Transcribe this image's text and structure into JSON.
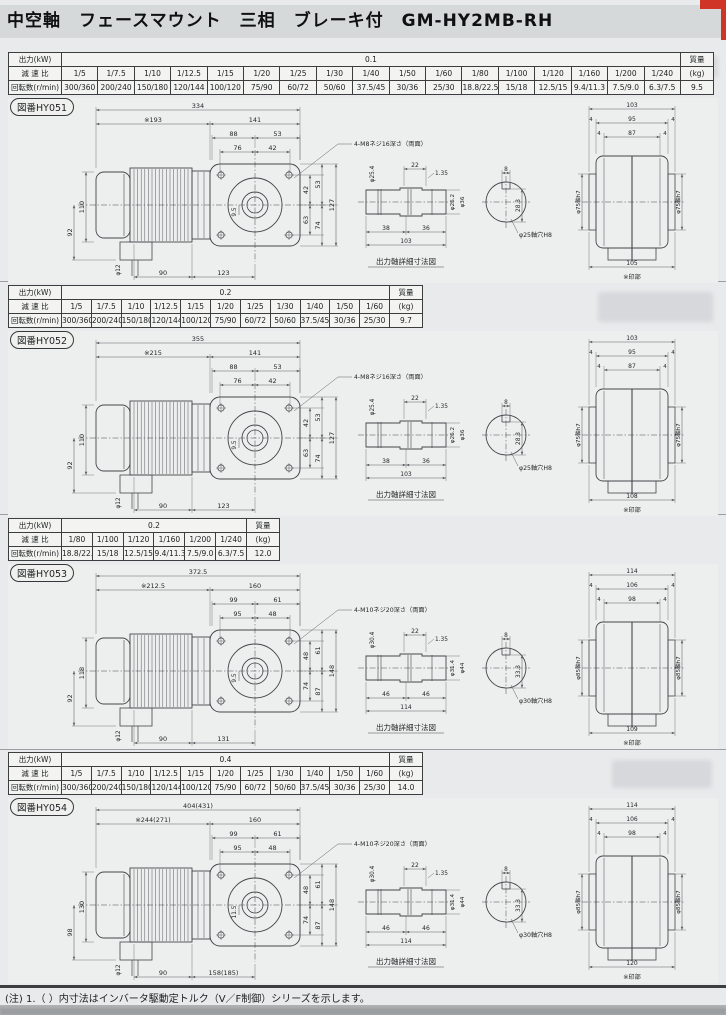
{
  "page": {
    "title": "中空軸　フェースマウント　三相　ブレーキ付　GM-HY2MB-RH",
    "footnote": "(注) 1.（ ）内寸法はインバータ駆動定トルク（V／F制御）シリーズを示します。"
  },
  "table_headers": {
    "output": "出力(kW)",
    "ratio": "減 速 比",
    "speed": "回転数(r/min)",
    "mass_top": "質量",
    "mass_unit": "(kg)"
  },
  "sections": [
    {
      "figure_no": "図番HY051",
      "spec": {
        "output_kw": "0.1",
        "mass_kg": "9.5",
        "ratios": [
          "1/5",
          "1/7.5",
          "1/10",
          "1/12.5",
          "1/15",
          "1/20",
          "1/25",
          "1/30",
          "1/40",
          "1/50",
          "1/60",
          "1/80",
          "1/100",
          "1/120",
          "1/160",
          "1/200",
          "1/240"
        ],
        "speeds": [
          "300/360",
          "200/240",
          "150/180",
          "120/144",
          "100/120",
          "75/90",
          "60/72",
          "50/60",
          "37.5/45",
          "30/36",
          "25/30",
          "18.8/22.5",
          "15/18",
          "12.5/15",
          "9.4/11.3",
          "7.5/9.0",
          "6.3/7.5"
        ]
      },
      "drawing": {
        "total": "334",
        "motor_len": "※193",
        "gear_len": "141",
        "face_top_a": "88",
        "face_top_b": "53",
        "face_top_c": "76",
        "face_top_d": "42",
        "callout": "4-M8ネジ16深さ（両面）",
        "motor_h": "110",
        "motor_h2": "92",
        "lead": "φ12",
        "bottom_a": "90",
        "bottom_b": "123",
        "right_a": "42",
        "right_b": "53",
        "right_c": "63",
        "right_d": "74",
        "right_e": "127",
        "inner": "9.5",
        "shaft": {
          "groove_w": "22",
          "groove_p": "1.35",
          "dia1": "φ25.4",
          "dia2": "φ26.2",
          "dia3": "φ36",
          "len_a": "38",
          "len_b": "36",
          "len_total": "103",
          "key_w": "8",
          "key_d": "28.3",
          "bore": "φ25軸穴H8",
          "caption": "出力軸詳細寸法図"
        },
        "end": {
          "w1": "103",
          "w2": "95",
          "w3": "87",
          "edge": "4",
          "side": "φ75軸h7",
          "w_bot": "105",
          "note": "※印部"
        }
      }
    },
    {
      "figure_no": "図番HY052",
      "spec": {
        "output_kw": "0.2",
        "mass_kg": "9.7",
        "ratios": [
          "1/5",
          "1/7.5",
          "1/10",
          "1/12.5",
          "1/15",
          "1/20",
          "1/25",
          "1/30",
          "1/40",
          "1/50",
          "1/60"
        ],
        "speeds": [
          "300/360",
          "200/240",
          "150/180",
          "120/144",
          "100/120",
          "75/90",
          "60/72",
          "50/60",
          "37.5/45",
          "30/36",
          "25/30"
        ]
      },
      "drawing": {
        "total": "355",
        "motor_len": "※215",
        "gear_len": "141",
        "face_top_a": "88",
        "face_top_b": "53",
        "face_top_c": "76",
        "face_top_d": "42",
        "callout": "4-M8ネジ16深さ（両面）",
        "motor_h": "110",
        "motor_h2": "92",
        "lead": "φ12",
        "bottom_a": "90",
        "bottom_b": "123",
        "right_a": "42",
        "right_b": "53",
        "right_c": "63",
        "right_d": "74",
        "right_e": "127",
        "inner": "9.5",
        "shaft": {
          "groove_w": "22",
          "groove_p": "1.35",
          "dia1": "φ25.4",
          "dia2": "φ26.2",
          "dia3": "φ36",
          "len_a": "38",
          "len_b": "36",
          "len_total": "103",
          "key_w": "8",
          "key_d": "28.3",
          "bore": "φ25軸穴H8",
          "caption": "出力軸詳細寸法図"
        },
        "end": {
          "w1": "103",
          "w2": "95",
          "w3": "87",
          "edge": "4",
          "side": "φ75軸h7",
          "w_bot": "108",
          "note": "※印部"
        }
      }
    },
    {
      "figure_no": "図番HY053",
      "spec": {
        "output_kw": "0.2",
        "mass_kg": "12.0",
        "ratios": [
          "1/80",
          "1/100",
          "1/120",
          "1/160",
          "1/200",
          "1/240"
        ],
        "speeds": [
          "18.8/22.5",
          "15/18",
          "12.5/15",
          "9.4/11.3",
          "7.5/9.0",
          "6.3/7.5"
        ]
      },
      "drawing": {
        "total": "372.5",
        "motor_len": "※212.5",
        "gear_len": "160",
        "face_top_a": "99",
        "face_top_b": "61",
        "face_top_c": "95",
        "face_top_d": "48",
        "callout": "4-M10ネジ20深さ（両面）",
        "motor_h": "118",
        "motor_h2": "92",
        "lead": "φ12",
        "bottom_a": "90",
        "bottom_b": "131",
        "right_a": "48",
        "right_b": "61",
        "right_c": "74",
        "right_d": "87",
        "right_e": "148",
        "inner": "9.5",
        "shaft": {
          "groove_w": "22",
          "groove_p": "1.35",
          "dia1": "φ30.4",
          "dia2": "φ31.4",
          "dia3": "φ44",
          "len_a": "46",
          "len_b": "46",
          "len_total": "114",
          "key_w": "8",
          "key_d": "33.3",
          "bore": "φ30軸穴H8",
          "caption": "出力軸詳細寸法図"
        },
        "end": {
          "w1": "114",
          "w2": "106",
          "w3": "98",
          "edge": "4",
          "side": "φ85軸h7",
          "w_bot": "109",
          "note": "※印部"
        }
      }
    },
    {
      "figure_no": "図番HY054",
      "spec": {
        "output_kw": "0.4",
        "mass_kg": "14.0",
        "ratios": [
          "1/5",
          "1/7.5",
          "1/10",
          "1/12.5",
          "1/15",
          "1/20",
          "1/25",
          "1/30",
          "1/40",
          "1/50",
          "1/60"
        ],
        "speeds": [
          "300/360",
          "200/240",
          "150/180",
          "120/144",
          "100/120",
          "75/90",
          "60/72",
          "50/60",
          "37.5/45",
          "30/36",
          "25/30"
        ]
      },
      "drawing": {
        "total": "404(431)",
        "motor_len": "※244(271)",
        "gear_len": "160",
        "face_top_a": "99",
        "face_top_b": "61",
        "face_top_c": "95",
        "face_top_d": "48",
        "callout": "4-M10ネジ20深さ（両面）",
        "motor_h": "130",
        "motor_h2": "98",
        "lead": "φ12",
        "bottom_a": "90",
        "bottom_b": "158(185)",
        "right_a": "48",
        "right_b": "61",
        "right_c": "74",
        "right_d": "87",
        "right_e": "148",
        "inner": "11.5",
        "shaft": {
          "groove_w": "22",
          "groove_p": "1.35",
          "dia1": "φ30.4",
          "dia2": "φ31.4",
          "dia3": "φ44",
          "len_a": "46",
          "len_b": "46",
          "len_total": "114",
          "key_w": "8",
          "key_d": "33.3",
          "bore": "φ30軸穴H8",
          "caption": "出力軸詳細寸法図"
        },
        "end": {
          "w1": "114",
          "w2": "106",
          "w3": "98",
          "edge": "4",
          "side": "φ85軸h7",
          "w_bot": "120",
          "note": "※印部"
        }
      }
    }
  ]
}
